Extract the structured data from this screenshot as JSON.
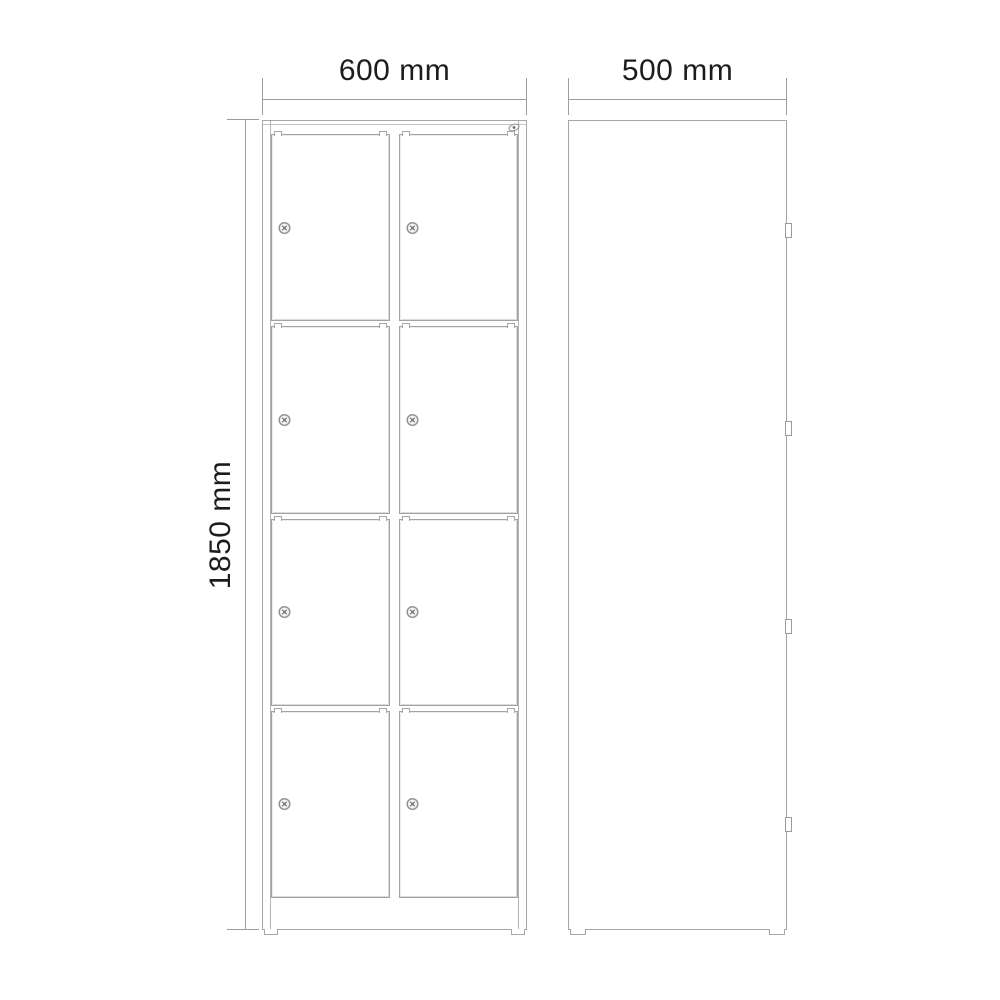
{
  "drawing": {
    "title": "locker-technical-drawing",
    "front_view": {
      "width_label": "600 mm",
      "height_label": "1850 mm",
      "door_rows": 4,
      "door_columns": 2
    },
    "side_view": {
      "depth_label": "500 mm",
      "hinge_count": 4
    },
    "icons": {
      "door_lock": "cam-lock-icon",
      "corner": "key-cylinder-icon"
    },
    "colors": {
      "background": "#ffffff",
      "line": "#a6a6a6",
      "dimension_line": "#9d9d9d",
      "text": "#1c1c1c"
    }
  }
}
